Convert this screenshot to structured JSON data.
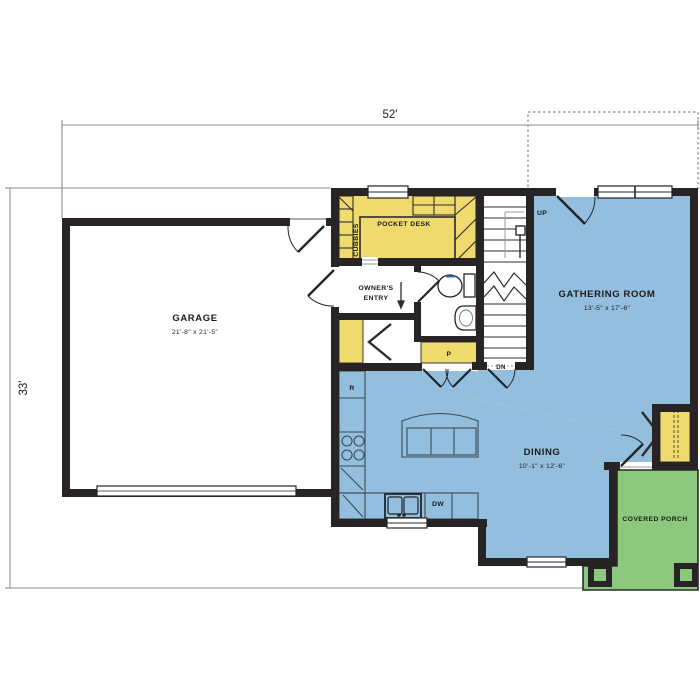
{
  "title": "First floor plan",
  "dimensions": {
    "overall_width": "52'",
    "overall_height": "33'"
  },
  "rooms": {
    "garage": {
      "label": "GARAGE",
      "size": "21'-8\" x 21'-5\""
    },
    "gathering": {
      "label": "GATHERING ROOM",
      "size": "13'-5\" x 17'-6\""
    },
    "dining": {
      "label": "DINING",
      "size": "10'-1\" x 12'-6\""
    },
    "porch": {
      "label": "COVERED PORCH"
    },
    "pocket_desk": {
      "label": "POCKET DESK"
    },
    "cubbies": {
      "label": "CUBBIES"
    },
    "owners_entry": {
      "line1": "OWNER'S",
      "line2": "ENTRY"
    }
  },
  "annotations": {
    "stairs_up": "UP",
    "stairs_down": "DN",
    "pantry": "P",
    "refrigerator": "R",
    "dishwasher": "DW"
  },
  "colors": {
    "floor_blue": "#93bedd",
    "cabinet_yellow": "#efda6d",
    "porch_green": "#8cc87e",
    "wall_black": "#282425",
    "dimension_gray": "#8f8f8f"
  }
}
